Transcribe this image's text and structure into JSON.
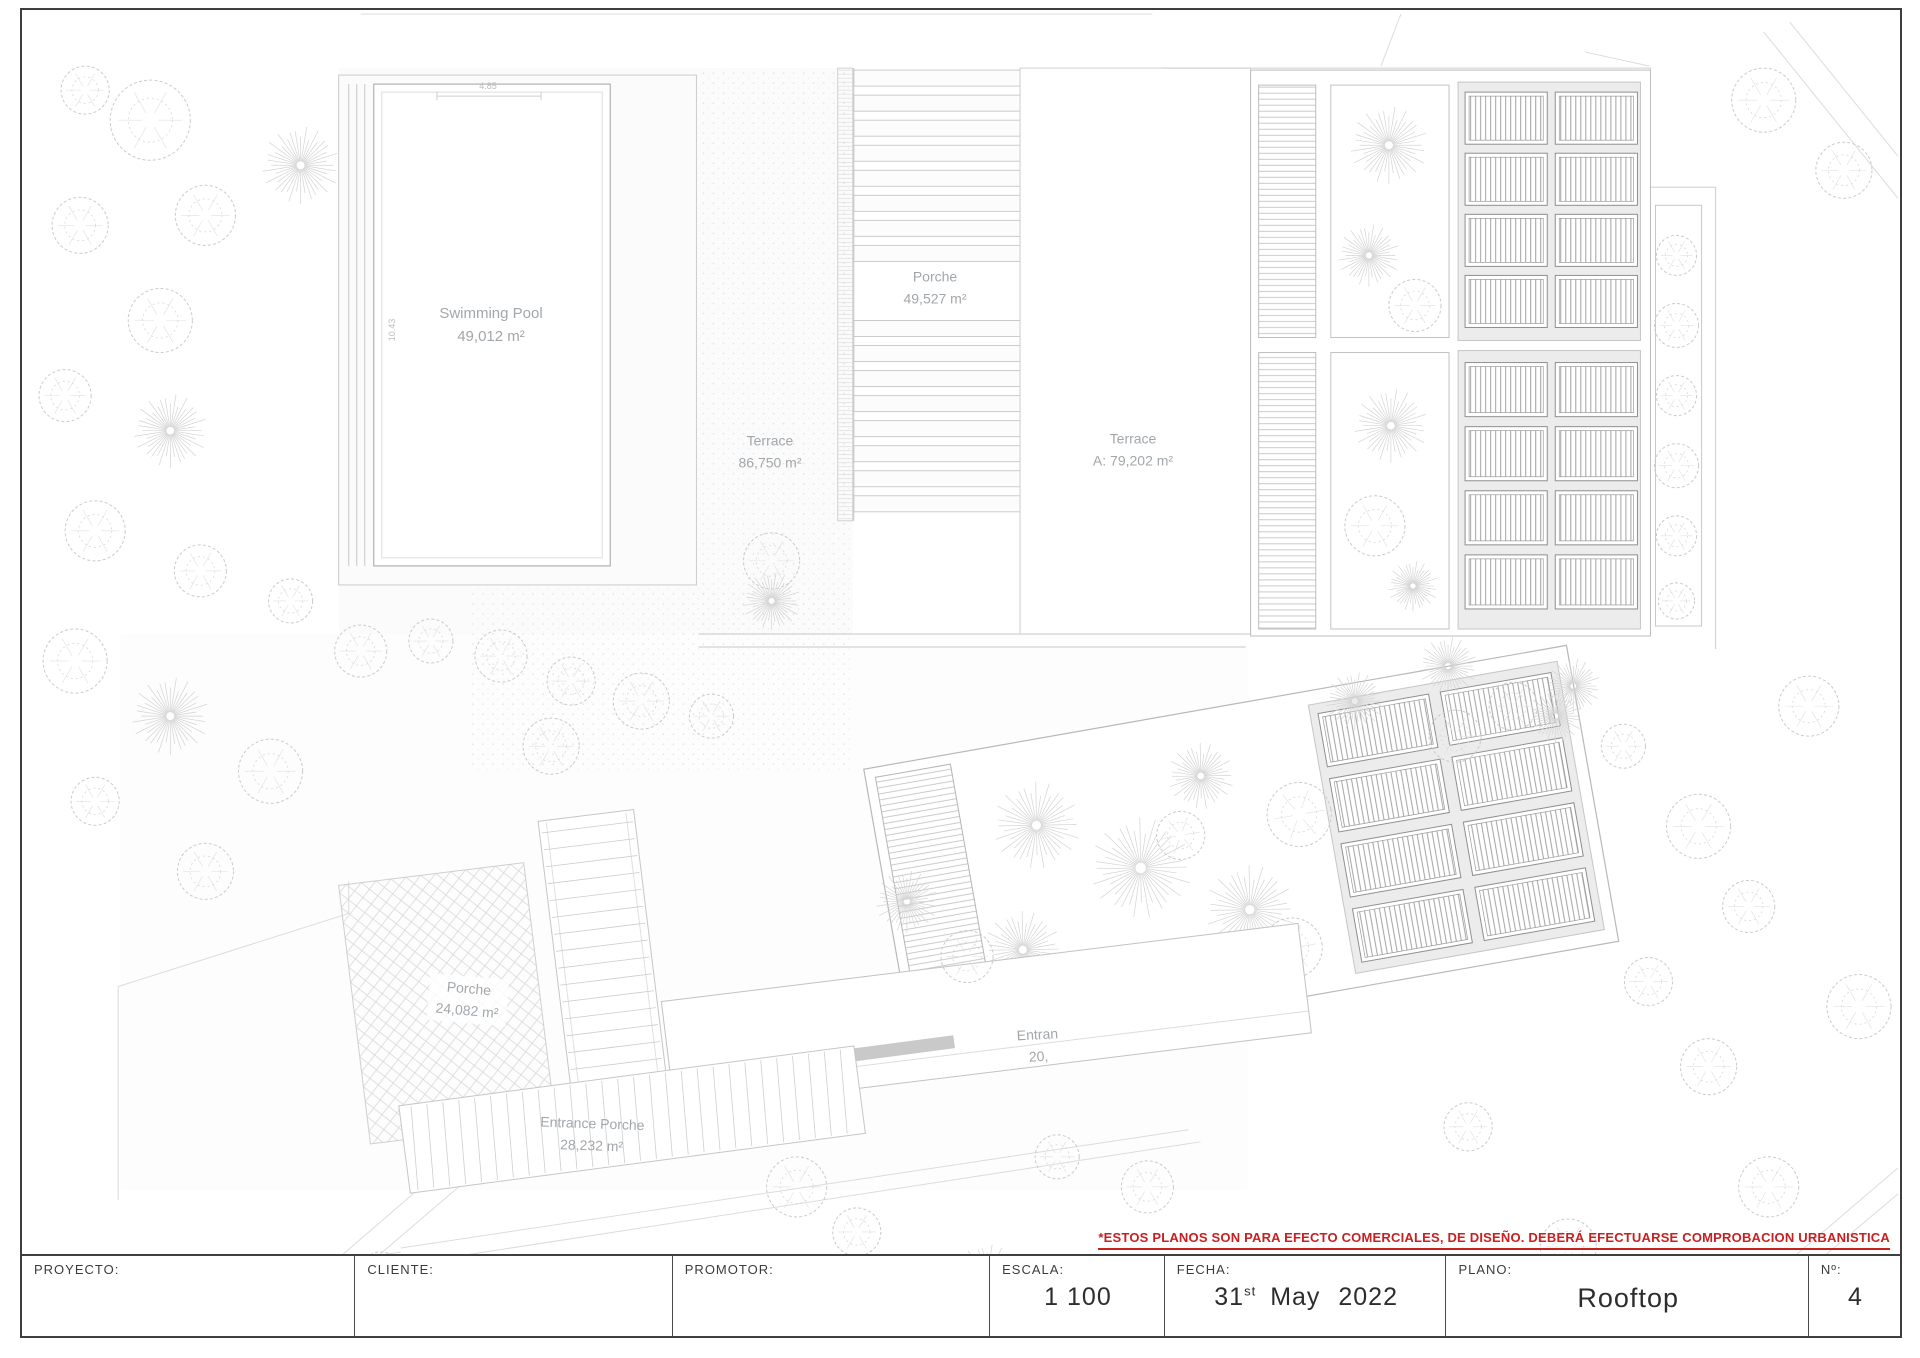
{
  "colors": {
    "disclaimer_red": "#c82020",
    "line_gray": "#cfcfcf",
    "label_gray": "#a2a7ab",
    "ink": "#3a3a3a"
  },
  "labels": {
    "swimming_pool": {
      "name": "Swimming Pool",
      "area": "49,012 m²"
    },
    "roof_porche": {
      "name": "Porche",
      "area": "49,527 m²"
    },
    "terrace": {
      "name": "Terrace",
      "area": "86,750 m²"
    },
    "terrace_a": {
      "name": "Terrace",
      "area": "A: 79,202 m²"
    },
    "side_porche": {
      "name": "Porche",
      "area": "24,082 m²"
    },
    "entrance_partial": {
      "line1": "Entran",
      "line2": "20,"
    },
    "entrance_porche": {
      "name": "Entrance Porche",
      "area": "28,232 m²"
    },
    "dim_width": "4.85",
    "dim_height": "10.43"
  },
  "disclaimer": "*ESTOS PLANOS SON PARA EFECTO COMERCIALES, DE DISEÑO. DEBERÁ EFECTUARSE COMPROBACION URBANISTICA",
  "title_block": {
    "fields": [
      {
        "label": "PROYECTO:",
        "value": ""
      },
      {
        "label": "CLIENTE:",
        "value": ""
      },
      {
        "label": "PROMOTOR:",
        "value": ""
      },
      {
        "label": "ESCALA:",
        "value": "1 100"
      },
      {
        "label": "FECHA:"
      },
      {
        "label": "PLANO:",
        "value": "Rooftop"
      },
      {
        "label": "Nº:",
        "value": "4"
      }
    ],
    "date": {
      "day": "31",
      "ordinal": "st",
      "rest": "May 2022"
    }
  }
}
